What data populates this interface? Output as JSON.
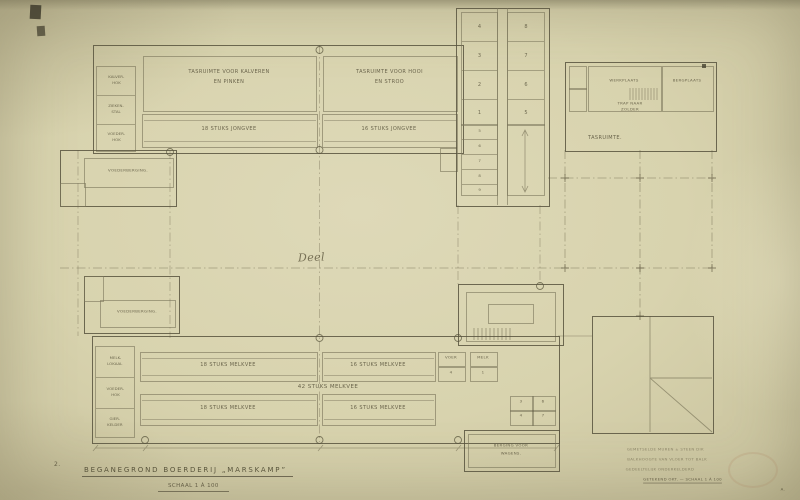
{
  "sheet": {
    "number": "2.",
    "corner_mark": "A."
  },
  "title": {
    "main": "BEGANEGROND  BOERDERIJ „MARSKAMP”",
    "scale": "SCHAAL 1 À 100"
  },
  "upper_barn": {
    "room_left": [
      "TASRUIMTE VOOR KALVEREN",
      "EN PINKEN"
    ],
    "room_right": [
      "TASRUIMTE VOOR HOOI",
      "EN STROO"
    ],
    "stall_left": "18 STUKS JONGVEE",
    "stall_right": "16 STUKS JONGVEE",
    "side_cells": [
      [
        "KALVER-",
        "HOK"
      ],
      [
        "ZIEKEN-",
        "STAL"
      ],
      [
        "VOEDER-",
        "HOK"
      ]
    ]
  },
  "left_wing_upper": {
    "label": "VOEDERBERGING."
  },
  "left_wing_lower": {
    "label": "VOEDERBERGING."
  },
  "strip_building": {
    "left_cells": [
      "4",
      "3",
      "2",
      "1"
    ],
    "right_cells": [
      "8",
      "7",
      "6",
      "5"
    ],
    "stall_numbers": [
      "5",
      "6",
      "7",
      "8",
      "9"
    ]
  },
  "right_building": {
    "room_left": "WERKPLAATS",
    "room_right": "BERGPLAATS",
    "stairs_note": [
      "TRAP NAAR",
      "ZOLDER"
    ],
    "hall": "TASRUIMTE."
  },
  "courtyard": {
    "label": "Deel"
  },
  "lower_barn": {
    "row_a_left": "18 STUKS MELKVEE",
    "row_a_right": "16 STUKS MELKVEE",
    "center": "42 STUKS MELKVEE",
    "row_b_left": "18 STUKS MELKVEE",
    "row_b_right": "16 STUKS MELKVEE",
    "mini_box_a": [
      "VOER",
      "4"
    ],
    "mini_box_b": [
      "MELK",
      "1"
    ],
    "grid_cells": [
      "3",
      "6",
      "4",
      "7"
    ],
    "side_cells": [
      [
        "MELK-",
        "LOKAAL"
      ],
      [
        "VOEDER-",
        "HOK"
      ],
      [
        "GIER-",
        "KELDER"
      ]
    ]
  },
  "wagon_shed": {
    "label": [
      "BERGING VOOR",
      "WAGENS."
    ]
  },
  "notes": {
    "line1": "GEMETSELDE MUREN ± STEEN DIK",
    "line2": "BALKHOOGTE VAN VLOER TOT BALK",
    "line3": "GEDEELTELIJK ONDERKELDERD",
    "line4": "GETEKEND OKT. — SCHAAL 1 À 100"
  },
  "colors": {
    "paper": "#d8d3ae",
    "ink": "#58533e",
    "pencil": "#7d775c"
  }
}
